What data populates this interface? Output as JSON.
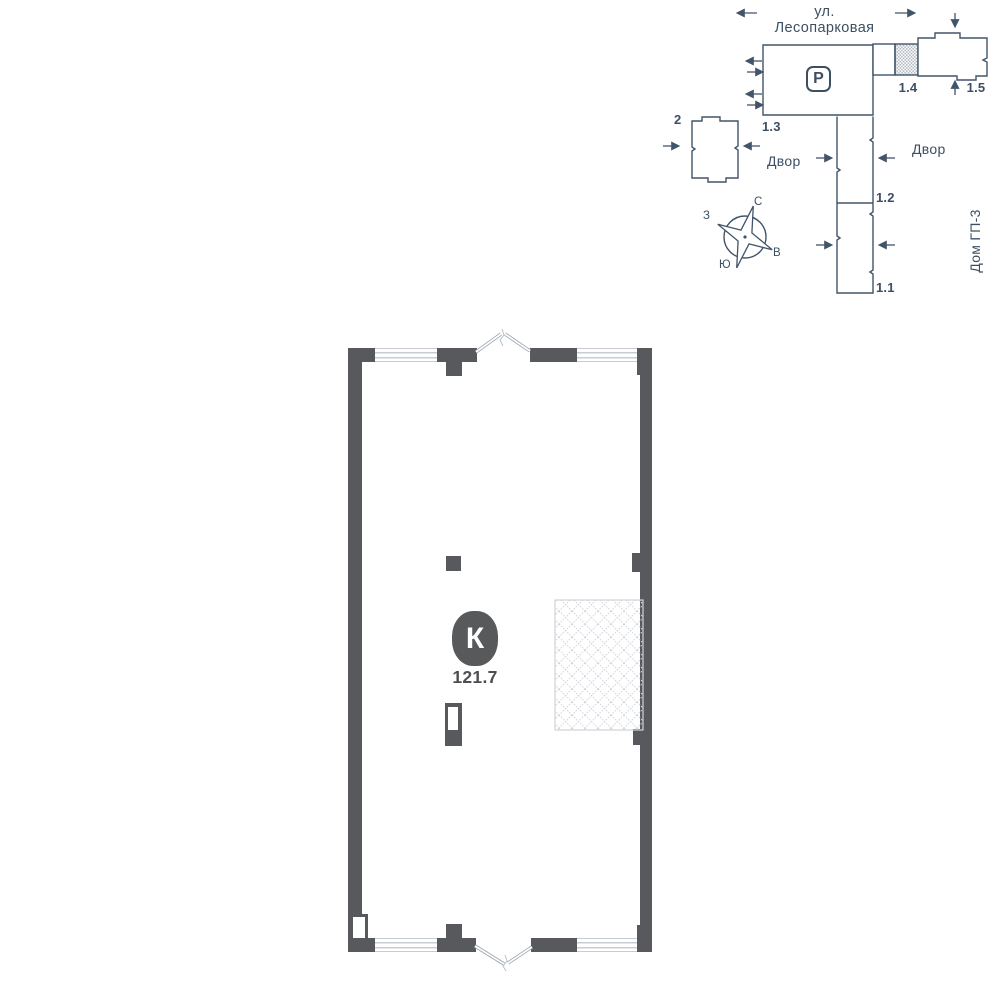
{
  "colors": {
    "wall": "#57595c",
    "plan_line": "#425469",
    "text": "#3d4f63",
    "window_line": "#c7ccd4",
    "door_line": "#9ba4ae",
    "hatch_line": "#d2d6db",
    "badge_bg": "#58595b",
    "badge_text": "#ffffff",
    "area_text": "#4b4d4f"
  },
  "sitemap": {
    "street_label": "ул. Лесопарковая",
    "parking_label": "Р",
    "building_labels": {
      "b1_1": "1.1",
      "b1_2": "1.2",
      "b1_3": "1.3",
      "b1_4": "1.4",
      "b1_5": "1.5",
      "b2": "2"
    },
    "yard_left": "Двор",
    "yard_right": "Двор",
    "neighbor_house": "Дом ГП-3",
    "compass": {
      "north": "С",
      "south": "Ю",
      "west": "З",
      "east": "В"
    }
  },
  "unit": {
    "type_letter": "К",
    "area": "121.7"
  }
}
